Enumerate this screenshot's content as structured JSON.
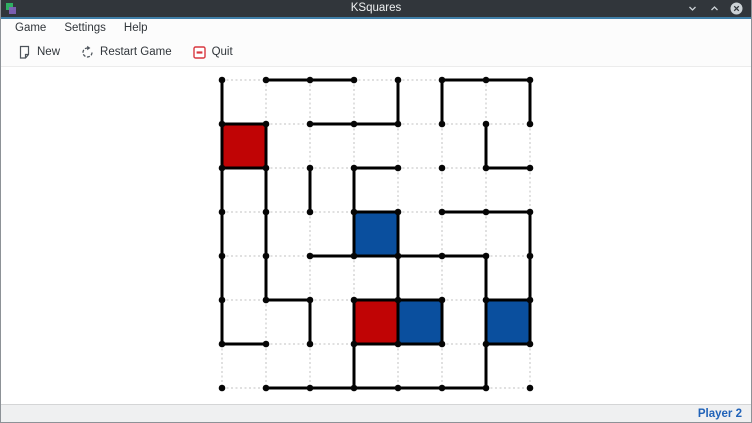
{
  "window": {
    "title": "KSquares",
    "app_icon": "ksquares-app-icon",
    "controls": {
      "minimize": "minimize-icon",
      "maximize": "maximize-icon",
      "close": "close-icon"
    }
  },
  "menu_bar": {
    "items": [
      {
        "label": "Game"
      },
      {
        "label": "Settings"
      },
      {
        "label": "Help"
      }
    ]
  },
  "toolbar": {
    "buttons": [
      {
        "label": "New",
        "icon": "new-document-icon"
      },
      {
        "label": "Restart Game",
        "icon": "restart-icon"
      },
      {
        "label": "Quit",
        "icon": "quit-icon"
      }
    ]
  },
  "board": {
    "grid": {
      "cols": 8,
      "rows": 8,
      "spacing": 44,
      "origin": {
        "x": 221,
        "y": 13
      }
    },
    "colors": {
      "line": "#000000",
      "dot": "#060606",
      "undrawn": "#c2c2c2",
      "red": "#c00405",
      "blue": "#0a4f9e"
    },
    "horizontal_edges": [
      "0110011",
      "1011000",
      "1001001",
      "0001011",
      "0011110",
      "0101101",
      "1001101",
      "0111110"
    ],
    "vertical_edges": [
      "1111110",
      "0111100",
      "0010010",
      "0011011",
      "1001110",
      "1000010",
      "0100111",
      "1001110"
    ],
    "filled_squares": [
      {
        "col": 0,
        "row": 1,
        "color": "red"
      },
      {
        "col": 3,
        "row": 3,
        "color": "blue"
      },
      {
        "col": 3,
        "row": 5,
        "color": "red"
      },
      {
        "col": 4,
        "row": 5,
        "color": "blue"
      },
      {
        "col": 6,
        "row": 5,
        "color": "blue"
      }
    ]
  },
  "status_bar": {
    "player_turn": "Player 2",
    "turn_color": "#2062b8"
  }
}
